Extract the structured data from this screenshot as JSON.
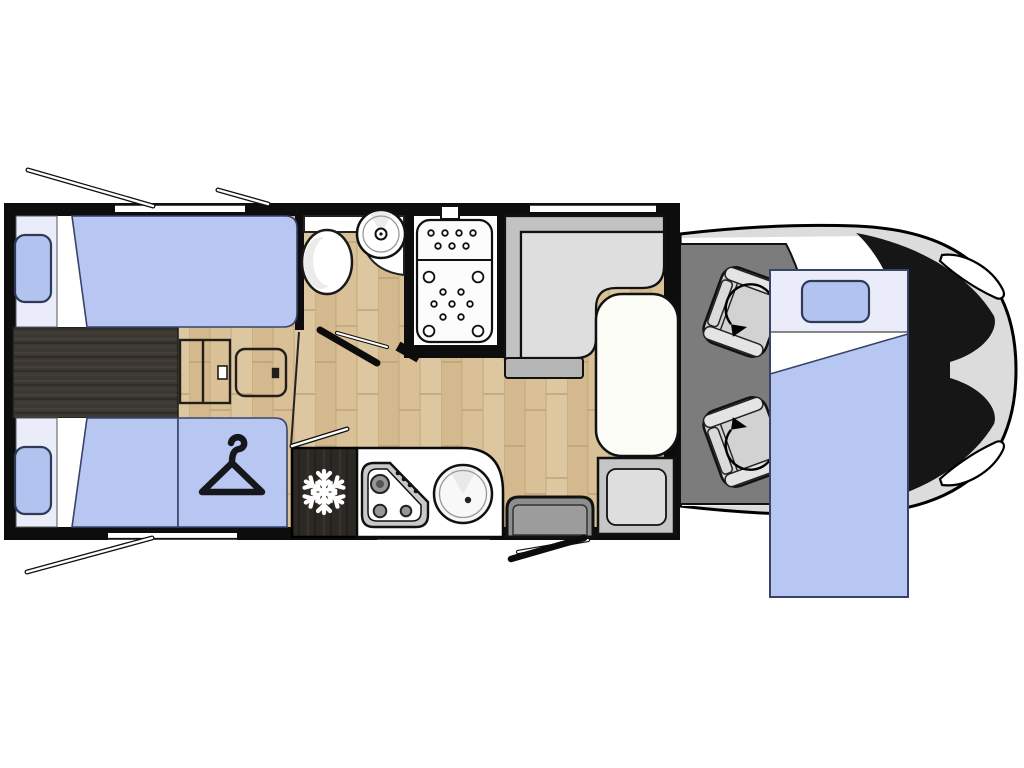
{
  "meta": {
    "title": "Motorhome floor plan, top view",
    "canvas_width": 1024,
    "canvas_height": 768,
    "text_content": "none - purely graphical diagram"
  },
  "colors": {
    "wall": "#0d0d0d",
    "wood": "#d9c096",
    "walkway": "#3b3833",
    "fridge": "#2c2823",
    "bed_blue": "#b7c7f1",
    "pillow_blue": "#b2c3ef",
    "pillow_panel": "#eaedf9",
    "bed_outline": "#39436a",
    "white": "#ffffff",
    "table": "#fdfdf7",
    "bench_back": "#c2c2c2",
    "bench_cushion": "#dedede",
    "bench_end": "#b5b5b5",
    "seat_frame": "#c6c6c6",
    "seat_inner": "#dedede",
    "step": "#8d8d8d",
    "step_inner": "#9c9c9c",
    "cab_floor": "#7c7c7c",
    "cab_seat": "#d2d2d2",
    "cab_seat_band": "#e4e4e4",
    "body": "#dcdcdc",
    "windshield": "#161616",
    "counter": "#ffffff",
    "hob_rim": "#c9c9c9",
    "burner": "#969696"
  },
  "legend": {
    "rear_bedroom": {
      "items": [
        "twin-bed-top",
        "twin-bed-bottom",
        "center-walkway",
        "storage-hatch-a",
        "storage-hatch-b",
        "wardrobe-with-hanger"
      ]
    },
    "bathroom": {
      "items": [
        "vanity-counter",
        "toilet",
        "washbasin",
        "open-door"
      ]
    },
    "shower": {
      "items": [
        "shower-tray",
        "shower-jets",
        "roof-vent"
      ]
    },
    "kitchen": {
      "items": [
        "refrigerator-snowflake",
        "three-burner-hob",
        "kitchen-sink",
        "counter"
      ]
    },
    "dinette": {
      "items": [
        "l-shaped-bench",
        "dining-table",
        "side-seat"
      ]
    },
    "entry": {
      "items": [
        "entry-step",
        "open-entry-door"
      ]
    },
    "cab": {
      "items": [
        "driver-swivel-seat",
        "passenger-swivel-seat",
        "windshield",
        "headlight-upper",
        "headlight-lower",
        "vehicle-body"
      ]
    },
    "front_bed": {
      "items": [
        "drop-down-bed",
        "pillow"
      ]
    },
    "open_window_indicators": 3,
    "window_openings_in_walls": 4
  },
  "icons": [
    {
      "name": "snowflake-icon",
      "meaning": "refrigerator"
    },
    {
      "name": "hanger-icon",
      "meaning": "wardrobe"
    },
    {
      "name": "swivel-arrow-icon",
      "meaning": "rotating cab seat"
    }
  ]
}
